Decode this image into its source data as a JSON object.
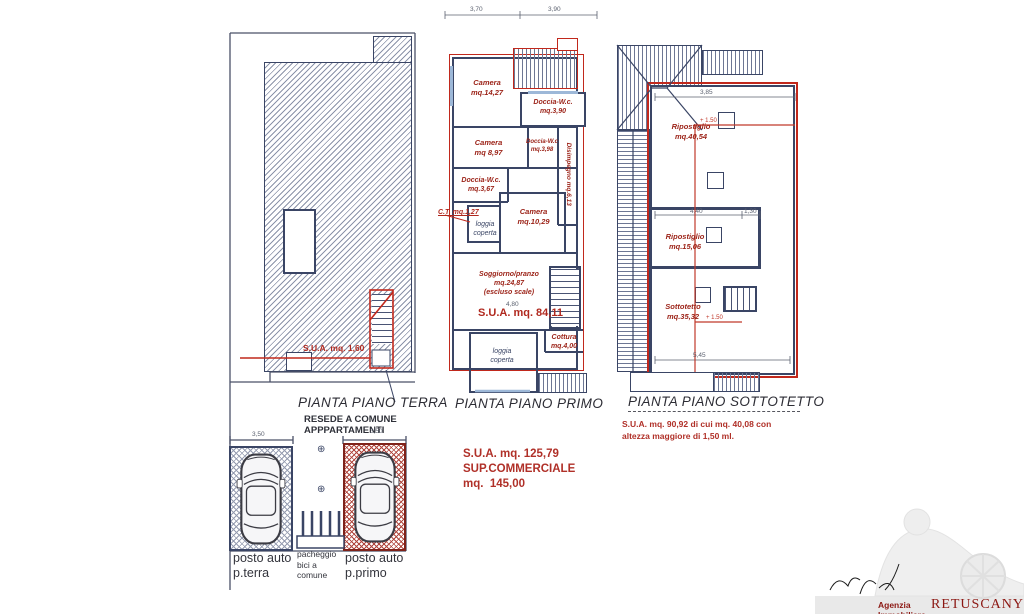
{
  "terra": {
    "title": "PIANTA PIANO TERRA",
    "sua": "S.U.A. mq. 1,60",
    "resede": "RESEDE A COMUNE\nAPPPARTAMENTI",
    "labels": {
      "posto_terra": "posto auto\np.terra",
      "bici": "pacheggio\nbici a\ncomune",
      "posto_primo": "posto auto\np.primo"
    },
    "dims": {
      "left_spot": "3,50",
      "right_spot": "3,50"
    }
  },
  "primo": {
    "title": "PIANTA PIANO PRIMO",
    "rooms": {
      "camera1": "Camera\nmq.14,27",
      "doccia1": "Doccia-W.c.\nmq.3,90",
      "camera2": "Camera\nmq 8,97",
      "doccia2": "Doccia-W.c\nmq.3,98",
      "disimpegno": "Disimpegno  mq.6,13",
      "doccia3": "Doccia-W.c.\nmq.3,67",
      "ct": "C.T. mq.1,27",
      "loggia_sup": "loggia\ncoperta",
      "camera3": "Camera\nmq.10,29",
      "soggiorno": "Soggiorno/pranzo\nmq.24,87\n(escluso scale)",
      "cottura": "Cottura\nmq.4,00",
      "loggia_inf": "loggia\ncoperta"
    },
    "sua_plan": "S.U.A. mq. 84,11",
    "summary": "S.U.A. mq. 125,79\nSUP.COMMERCIALE\nmq.  145,00",
    "dims": {
      "top_left": "3,70",
      "top_right": "3,90",
      "soggiorno": "4,80"
    }
  },
  "sottotetto": {
    "title": "PIANTA PIANO SOTTOTETTO",
    "rooms": {
      "ripostiglio1": "Ripostiglio\nmq.40,54",
      "ripostiglio2": "Ripostiglio\nmq.15,06",
      "sottotetto": "Sottotetto\nmq.35,32"
    },
    "height_marks": {
      "upper": "+ 1.50",
      "lower": "+ 1.50"
    },
    "summary": "S.U.A. mq. 90,92 di cui mq. 40,08 con\naltezza maggiore di 1,50 ml.",
    "dims": {
      "top": "3,85",
      "mid_left": "4,40",
      "mid_right": "1,30",
      "bottom": "5,45"
    }
  },
  "watermark": {
    "agency_prefix": "Agenzia Immobiliare",
    "agency_name": "RETUSCANY"
  },
  "symbols": {
    "survey_point": "⊕"
  },
  "colors": {
    "wall": "#3a4565",
    "red_line": "#c1281c",
    "red_text": "#a8281e",
    "hatch": "#8b93a9"
  }
}
